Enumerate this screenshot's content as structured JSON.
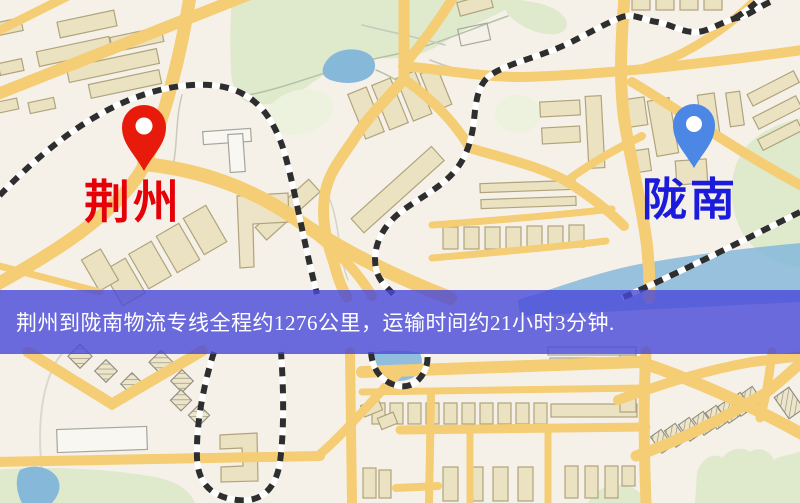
{
  "map": {
    "origin": {
      "name": "荆州",
      "label_color": "#e60008",
      "pin_color": "#e81a0c"
    },
    "destination": {
      "name": "陇南",
      "label_color": "#1b1bdc",
      "pin_color": "#4c87e6"
    },
    "banner": {
      "text": "荆州到陇南物流专线全程约1276公里，运输时间约21小时3分钟.",
      "background_color": "#4848d8",
      "text_color": "#ffffff"
    },
    "route": {
      "distance_text": "约1276公里",
      "duration_text": "约21小时3分钟"
    },
    "colors": {
      "background": "#f6f1e8",
      "road": "#f4cd74",
      "park": "#dfe9cc",
      "park_light": "#edf2de",
      "water": "#86b8da",
      "building": "#ebe2c2",
      "building_outline": "#b0a47c",
      "railway": "#2e2e2e",
      "railway_base": "#ffffff"
    }
  }
}
